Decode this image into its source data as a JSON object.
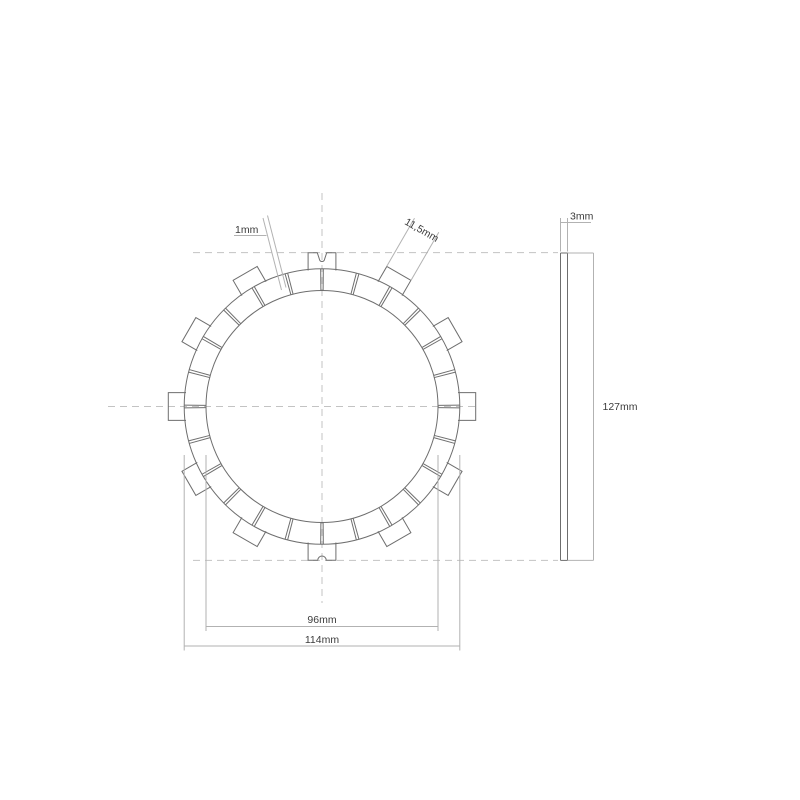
{
  "drawing": {
    "type": "technical-drawing",
    "subject": "clutch friction plate - front view and side view",
    "colors": {
      "background": "#ffffff",
      "geometry_line": "#6e6e6e",
      "dimension_line": "#b2b2b2",
      "centerline": "#c3c3c3",
      "text": "#3c3c3c"
    },
    "front_view": {
      "cx": 322,
      "cy": 406.5,
      "inner_radius_px": 116,
      "pad_outer_radius_px": 137.8,
      "tab_outer_radius_px": 153.7,
      "tab_inner_radius_px": 136,
      "tab_half_width_px": 13.9,
      "tab_count": 12,
      "tab_angle_step_deg": 30,
      "pad_count": 24,
      "groove_count": 24,
      "groove_half_angle_deg": 0.55,
      "notched_tab_angles_deg": [
        90,
        270
      ]
    },
    "side_view": {
      "x_left": 560.5,
      "x_right": 567.5,
      "y_top": 253,
      "y_bottom": 560.4,
      "dim_line_x": 593.5
    }
  },
  "dimensions": {
    "groove_width": {
      "label": "1mm"
    },
    "tab_width": {
      "label": "11,5mm"
    },
    "thickness": {
      "label": "3mm"
    },
    "outer_diameter": {
      "label": "127mm"
    },
    "friction_inner_diameter": {
      "label": "96mm"
    },
    "friction_outer_diameter": {
      "label": "114mm"
    }
  }
}
